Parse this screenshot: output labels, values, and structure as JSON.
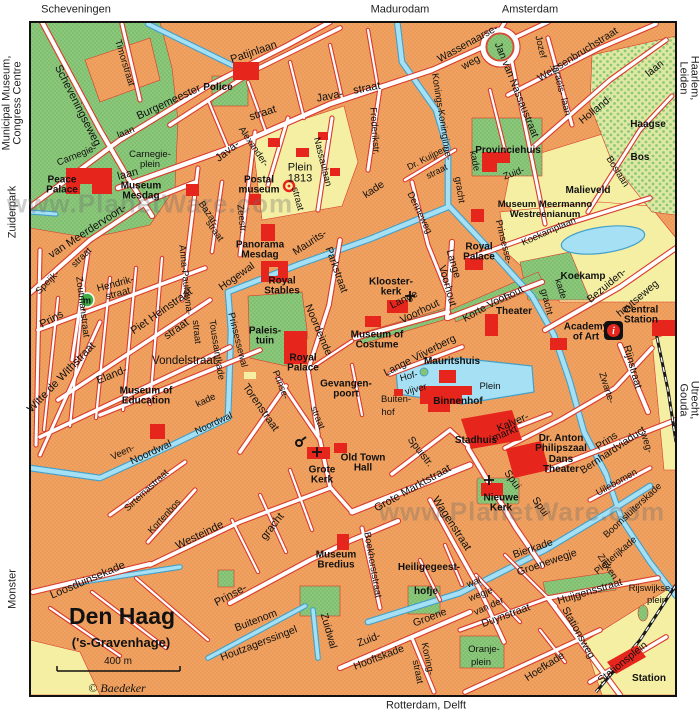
{
  "colors": {
    "land": "#efa261",
    "street": "#ffffff",
    "street_casing": "#d93b2c",
    "water": "#a5e0f5",
    "water_edge": "#44a0c8",
    "park": "#8cc87c",
    "wood": "#dfe8a0",
    "field": "#f4efa3",
    "building": "#e6251c",
    "rail": "#1a1a1a",
    "marker_green": "#3fae49",
    "border": "#111111"
  },
  "icons": {
    "info": "i",
    "stop": "m"
  },
  "labels": {
    "edge": [
      {
        "t": "Scheveningen",
        "x": 76,
        "y": 10
      },
      {
        "t": "Madurodam",
        "x": 400,
        "y": 10
      },
      {
        "t": "Amsterdam",
        "x": 530,
        "y": 10
      },
      {
        "t": "Haarlem, Leiden",
        "x": 688,
        "y": 78,
        "r": 90
      },
      {
        "t": "Utrecht, Gouda",
        "x": 688,
        "y": 400,
        "r": 90
      },
      {
        "t": "Rotterdam, Delft",
        "x": 426,
        "y": 706
      },
      {
        "t": "Municipal Museum,\nCongress Centre",
        "x": 13,
        "y": 103,
        "r": -90
      },
      {
        "t": "Zuiderpark",
        "x": 13,
        "y": 212,
        "r": -90
      },
      {
        "t": "Monster",
        "x": 13,
        "y": 589,
        "r": -90
      }
    ],
    "watermarks": [
      {
        "t": "www.PlanetWare.com",
        "x": 150,
        "y": 204
      },
      {
        "t": "www.PlanetWare.com",
        "x": 522,
        "y": 512
      }
    ],
    "titles": [
      {
        "t": "Den Haag",
        "x": 122,
        "y": 617,
        "fs": 23
      },
      {
        "t": "('s-Gravenhage)",
        "x": 121,
        "y": 643,
        "fs": 13
      },
      {
        "t": "400 m",
        "x": 118,
        "y": 662,
        "fs": 10,
        "b": 0
      },
      {
        "t": "© Baedeker",
        "x": 117,
        "y": 688,
        "fs": 12,
        "b": 0,
        "it": 1,
        "sf": 1
      }
    ],
    "streets": [
      {
        "t": "Scheveningseweg",
        "x": 77,
        "y": 106,
        "r": 63,
        "fs": 11
      },
      {
        "t": "Timorstraat",
        "x": 124,
        "y": 63,
        "r": 73
      },
      {
        "t": "Burgemeester",
        "x": 169,
        "y": 103,
        "r": -25,
        "fs": 11
      },
      {
        "t": "Patijnlaan",
        "x": 254,
        "y": 53,
        "r": -19,
        "fs": 11
      },
      {
        "t": "Carnegie-",
        "x": 77,
        "y": 156,
        "r": -22
      },
      {
        "t": "laan",
        "x": 126,
        "y": 133,
        "r": -22
      },
      {
        "t": "Carnegie-\nplein",
        "x": 150,
        "y": 160
      },
      {
        "t": "Plein\n1813",
        "x": 300,
        "y": 174,
        "fs": 11
      },
      {
        "t": "laan",
        "x": 128,
        "y": 175,
        "r": -15,
        "fs": 11
      },
      {
        "t": "van Meerdervoort-",
        "x": 88,
        "y": 232,
        "r": -33,
        "fs": 11
      },
      {
        "t": "Speijk-",
        "x": 48,
        "y": 283,
        "r": -45
      },
      {
        "t": "straat",
        "x": 82,
        "y": 258,
        "r": -45
      },
      {
        "t": "Zoutmanstraat",
        "x": 82,
        "y": 307,
        "r": 83
      },
      {
        "t": "Prins",
        "x": 52,
        "y": 320,
        "r": -28,
        "fs": 11
      },
      {
        "t": "Hendrik-\nstraat",
        "x": 117,
        "y": 290,
        "r": -15,
        "fs": 10
      },
      {
        "t": "Piet Heinstraat",
        "x": 162,
        "y": 312,
        "r": -35,
        "fs": 11
      },
      {
        "t": "Witte de Withstraat",
        "x": 62,
        "y": 378,
        "r": -46,
        "fs": 11
      },
      {
        "t": "Eland-",
        "x": 112,
        "y": 376,
        "r": -22,
        "fs": 11
      },
      {
        "t": "straat",
        "x": 177,
        "y": 330,
        "r": -35,
        "fs": 11
      },
      {
        "t": "Vondelstraat",
        "x": 184,
        "y": 362,
        "fs": 11.5
      },
      {
        "t": "Anna-Paulowna-",
        "x": 185,
        "y": 280,
        "r": 84
      },
      {
        "t": "straat",
        "x": 196,
        "y": 332,
        "r": 84
      },
      {
        "t": "Bazar-",
        "x": 208,
        "y": 214,
        "r": 55
      },
      {
        "t": "straat",
        "x": 214,
        "y": 231,
        "r": 55
      },
      {
        "t": "Zeestr.",
        "x": 241,
        "y": 219,
        "r": 84
      },
      {
        "t": "straat",
        "x": 263,
        "y": 114,
        "r": -18,
        "fs": 11
      },
      {
        "t": "Java-",
        "x": 228,
        "y": 152,
        "r": -38,
        "fs": 11
      },
      {
        "t": "Java-",
        "x": 330,
        "y": 97,
        "r": -11,
        "fs": 11
      },
      {
        "t": "straat",
        "x": 367,
        "y": 89,
        "r": -11,
        "fs": 11
      },
      {
        "t": "Alexander-",
        "x": 253,
        "y": 147,
        "r": 56
      },
      {
        "t": "straat",
        "x": 297,
        "y": 199,
        "r": 75
      },
      {
        "t": "Nassaulaan",
        "x": 322,
        "y": 162,
        "r": 76
      },
      {
        "t": "Frederikstr.",
        "x": 374,
        "y": 131,
        "r": 86
      },
      {
        "t": "Maurits-",
        "x": 310,
        "y": 243,
        "r": -33,
        "fs": 10.5
      },
      {
        "t": "kade",
        "x": 374,
        "y": 190,
        "r": -33,
        "fs": 10.5
      },
      {
        "t": "Hogewal",
        "x": 237,
        "y": 277,
        "r": -35,
        "fs": 10.5
      },
      {
        "t": "Parkstraat",
        "x": 336,
        "y": 270,
        "r": 70,
        "fs": 10.5
      },
      {
        "t": "Noordeinde",
        "x": 318,
        "y": 330,
        "r": 67,
        "fs": 10.5
      },
      {
        "t": "Toussaintkade",
        "x": 216,
        "y": 350,
        "r": 81
      },
      {
        "t": "Prinsessewal",
        "x": 237,
        "y": 340,
        "r": 76
      },
      {
        "t": "Prinse-",
        "x": 280,
        "y": 385,
        "r": 68
      },
      {
        "t": "straat",
        "x": 317,
        "y": 418,
        "r": 68
      },
      {
        "t": "Torenstraat",
        "x": 260,
        "y": 408,
        "r": 55,
        "fs": 11
      },
      {
        "t": "kade",
        "x": 206,
        "y": 401,
        "r": -25
      },
      {
        "t": "Noordwal",
        "x": 214,
        "y": 424,
        "r": -25
      },
      {
        "t": "Veen-",
        "x": 123,
        "y": 453,
        "r": -25
      },
      {
        "t": "Noordwal",
        "x": 151,
        "y": 453,
        "r": -25,
        "fs": 10.5
      },
      {
        "t": "Lange",
        "x": 404,
        "y": 300,
        "r": -26,
        "fs": 10.5
      },
      {
        "t": "Voorhout",
        "x": 420,
        "y": 312,
        "r": -26,
        "fs": 10.5
      },
      {
        "t": "Lange",
        "x": 453,
        "y": 264,
        "r": 74,
        "fs": 10.5
      },
      {
        "t": "Voorhout",
        "x": 447,
        "y": 286,
        "r": 74,
        "fs": 10.5
      },
      {
        "t": "Korte Voor-",
        "x": 487,
        "y": 307,
        "r": -29,
        "fs": 10.5
      },
      {
        "t": "hout",
        "x": 514,
        "y": 294,
        "r": -29,
        "fs": 10.5
      },
      {
        "t": "Lange Vijverberg",
        "x": 420,
        "y": 356,
        "r": -27,
        "fs": 10.5
      },
      {
        "t": "Hof-",
        "x": 409,
        "y": 377,
        "r": -15
      },
      {
        "t": "vijver",
        "x": 416,
        "y": 390,
        "r": -15
      },
      {
        "t": "Buiten-",
        "x": 396,
        "y": 400
      },
      {
        "t": "hof",
        "x": 388,
        "y": 413
      },
      {
        "t": "Plein",
        "x": 490,
        "y": 387
      },
      {
        "t": "Wassenaarse-",
        "x": 468,
        "y": 44,
        "r": -29,
        "fs": 10.5
      },
      {
        "t": "weg",
        "x": 471,
        "y": 63,
        "r": -29,
        "fs": 10.5
      },
      {
        "t": "Jan van Nassaustraat",
        "x": 516,
        "y": 90,
        "r": 68,
        "fs": 10.5
      },
      {
        "t": "Jozef",
        "x": 540,
        "y": 47,
        "r": 77
      },
      {
        "t": "Israels-",
        "x": 558,
        "y": 80,
        "r": 77
      },
      {
        "t": "laan",
        "x": 565,
        "y": 107,
        "r": 77
      },
      {
        "t": "Weissenbruchstraat",
        "x": 578,
        "y": 55,
        "r": -32,
        "fs": 10.5
      },
      {
        "t": "Holland-",
        "x": 596,
        "y": 110,
        "r": -39,
        "fs": 10.5
      },
      {
        "t": "laan",
        "x": 655,
        "y": 69,
        "r": -39,
        "fs": 10.5
      },
      {
        "t": "Boslaan",
        "x": 617,
        "y": 172,
        "r": 58
      },
      {
        "t": "Konings-",
        "x": 437,
        "y": 92,
        "r": 81
      },
      {
        "t": "Koninginne-",
        "x": 444,
        "y": 135,
        "r": 81
      },
      {
        "t": "gracht",
        "x": 459,
        "y": 190,
        "r": 81
      },
      {
        "t": "kade",
        "x": 474,
        "y": 161,
        "r": 78
      },
      {
        "t": "Dr. Kuijper-",
        "x": 428,
        "y": 158,
        "r": -27,
        "fs": 9
      },
      {
        "t": "straat",
        "x": 437,
        "y": 172,
        "r": -27,
        "fs": 9
      },
      {
        "t": "Denneweg",
        "x": 419,
        "y": 213,
        "r": 64
      },
      {
        "t": "Zuid-",
        "x": 514,
        "y": 174,
        "r": -20
      },
      {
        "t": "Prinsesse-",
        "x": 503,
        "y": 242,
        "r": 76
      },
      {
        "t": "gracht",
        "x": 546,
        "y": 302,
        "r": 76
      },
      {
        "t": "kade",
        "x": 560,
        "y": 289,
        "r": 72
      },
      {
        "t": "Koekamplaan",
        "x": 549,
        "y": 232,
        "r": -24
      },
      {
        "t": "Bezuiden-",
        "x": 607,
        "y": 286,
        "r": -40,
        "fs": 10.5
      },
      {
        "t": "houtseweg",
        "x": 638,
        "y": 299,
        "r": -40,
        "fs": 10.5
      },
      {
        "t": "Rijnstraat",
        "x": 632,
        "y": 367,
        "r": 74,
        "fs": 10.5
      },
      {
        "t": "Zwarte-",
        "x": 606,
        "y": 388,
        "r": 72
      },
      {
        "t": "weg-",
        "x": 646,
        "y": 443,
        "r": 72
      },
      {
        "t": "Prins Bernhardviaduct",
        "x": 610,
        "y": 446,
        "r": -34,
        "fs": 10.5
      },
      {
        "t": "Kalver-",
        "x": 513,
        "y": 423,
        "r": -23,
        "fs": 10.5
      },
      {
        "t": "markt",
        "x": 505,
        "y": 434,
        "r": -23,
        "fs": 10.5
      },
      {
        "t": "Spuistr.",
        "x": 420,
        "y": 452,
        "r": 52,
        "fs": 10.5
      },
      {
        "t": "Grote Marktstraat",
        "x": 413,
        "y": 489,
        "r": -29,
        "fs": 11
      },
      {
        "t": "Wagenstraat",
        "x": 451,
        "y": 524,
        "r": 57,
        "fs": 11
      },
      {
        "t": "Spui",
        "x": 512,
        "y": 480,
        "r": 55,
        "fs": 10.5
      },
      {
        "t": "Spui",
        "x": 540,
        "y": 507,
        "r": 55,
        "fs": 10.5
      },
      {
        "t": "gracht",
        "x": 273,
        "y": 527,
        "r": -52,
        "fs": 11
      },
      {
        "t": "Boekhorststraat",
        "x": 372,
        "y": 565,
        "r": 80
      },
      {
        "t": "Westeinde",
        "x": 200,
        "y": 536,
        "r": -26,
        "fs": 11
      },
      {
        "t": "Kortenbos",
        "x": 165,
        "y": 517,
        "r": -47
      },
      {
        "t": "Sirtemastraat",
        "x": 147,
        "y": 491,
        "r": -43
      },
      {
        "t": "Loosduinsekade",
        "x": 88,
        "y": 581,
        "r": -23,
        "fs": 11
      },
      {
        "t": "Prinse-",
        "x": 231,
        "y": 596,
        "r": -28,
        "fs": 11
      },
      {
        "t": "Buitenom",
        "x": 256,
        "y": 621,
        "r": -21,
        "fs": 10.5
      },
      {
        "t": "Houtzagerssingel",
        "x": 259,
        "y": 644,
        "r": -21,
        "fs": 10.5
      },
      {
        "t": "Zuidwal",
        "x": 328,
        "y": 631,
        "r": 74,
        "fs": 10.5
      },
      {
        "t": "Zuid-",
        "x": 369,
        "y": 640,
        "r": -21,
        "fs": 10.5
      },
      {
        "t": "Hooftskade",
        "x": 379,
        "y": 658,
        "r": -21,
        "fs": 10.5
      },
      {
        "t": "Koning-",
        "x": 427,
        "y": 659,
        "r": 78
      },
      {
        "t": "straat",
        "x": 417,
        "y": 672,
        "r": 78
      },
      {
        "t": "Oranje-",
        "x": 484,
        "y": 650
      },
      {
        "t": "plein",
        "x": 481,
        "y": 663
      },
      {
        "t": "Groene",
        "x": 430,
        "y": 618,
        "r": -21,
        "fs": 10.5
      },
      {
        "t": "wal",
        "x": 474,
        "y": 583,
        "r": -21
      },
      {
        "t": "wegje",
        "x": 481,
        "y": 595,
        "r": -21
      },
      {
        "t": "van der",
        "x": 489,
        "y": 607,
        "r": -24
      },
      {
        "t": "Duynstraat",
        "x": 506,
        "y": 616,
        "r": -20,
        "fs": 10.5
      },
      {
        "t": "Huijgensstraat",
        "x": 590,
        "y": 592,
        "r": -17,
        "fs": 10.5
      },
      {
        "t": "Bierkade",
        "x": 533,
        "y": 549,
        "r": -19,
        "fs": 10.5
      },
      {
        "t": "Groenewegje",
        "x": 547,
        "y": 563,
        "r": -19,
        "fs": 10.5
      },
      {
        "t": "Uilebomen",
        "x": 617,
        "y": 483,
        "r": -29
      },
      {
        "t": "Boomsluiterskade",
        "x": 633,
        "y": 511,
        "r": -43
      },
      {
        "t": "Pletterijkade",
        "x": 616,
        "y": 556,
        "r": -41
      },
      {
        "t": "Zieken",
        "x": 607,
        "y": 567,
        "r": 56
      },
      {
        "t": "Rijswijkse-",
        "x": 651,
        "y": 589
      },
      {
        "t": "plein",
        "x": 657,
        "y": 601
      },
      {
        "t": "Stationsweg",
        "x": 578,
        "y": 633,
        "r": 61,
        "fs": 10.5
      },
      {
        "t": "Stationsplein",
        "x": 623,
        "y": 663,
        "r": -39,
        "fs": 10.5
      },
      {
        "t": "Hoefkade",
        "x": 545,
        "y": 667,
        "r": -33,
        "fs": 10.5
      }
    ],
    "pois": [
      {
        "t": "Police",
        "x": 218,
        "y": 88,
        "fs": 10
      },
      {
        "t": "Peace\nPalace",
        "x": 62,
        "y": 186,
        "fs": 10
      },
      {
        "t": "Museum\nMesdag",
        "x": 141,
        "y": 192,
        "fs": 10
      },
      {
        "t": "Postal\nmuseum",
        "x": 259,
        "y": 186,
        "fs": 10
      },
      {
        "t": "Panorama\nMesdag",
        "x": 260,
        "y": 251,
        "fs": 10
      },
      {
        "t": "Royal\nStables",
        "x": 282,
        "y": 287,
        "fs": 10
      },
      {
        "t": "Paleis-\ntuin",
        "x": 265,
        "y": 337,
        "fs": 10
      },
      {
        "t": "Royal\nPalace",
        "x": 303,
        "y": 364,
        "fs": 10
      },
      {
        "t": "Klooster-\nkerk",
        "x": 391,
        "y": 288,
        "fs": 10
      },
      {
        "t": "Museum of\nCostume",
        "x": 377,
        "y": 341,
        "fs": 10
      },
      {
        "t": "Mauritshuis",
        "x": 452,
        "y": 362,
        "fs": 10
      },
      {
        "t": "Gevangen-\npoort",
        "x": 346,
        "y": 390,
        "fs": 10
      },
      {
        "t": "Binnenhof",
        "x": 458,
        "y": 402,
        "fs": 10
      },
      {
        "t": "Royal\nPalace",
        "x": 479,
        "y": 253,
        "fs": 10
      },
      {
        "t": "Theater",
        "x": 514,
        "y": 312,
        "fs": 10
      },
      {
        "t": "Academy\nof Art",
        "x": 586,
        "y": 333,
        "fs": 10
      },
      {
        "t": "Central\nStation",
        "x": 641,
        "y": 316,
        "fs": 10
      },
      {
        "t": "Koekamp",
        "x": 583,
        "y": 277,
        "fs": 10
      },
      {
        "t": "Malieveld",
        "x": 588,
        "y": 191,
        "fs": 10
      },
      {
        "t": "Haagse",
        "x": 648,
        "y": 125,
        "fs": 10
      },
      {
        "t": "Bos",
        "x": 640,
        "y": 158,
        "fs": 10
      },
      {
        "t": "Provinciehuis",
        "x": 508,
        "y": 151,
        "fs": 10
      },
      {
        "t": "Museum Meermanno\nWestreenianum",
        "x": 545,
        "y": 210
      },
      {
        "t": "Museum of\nEducation",
        "x": 146,
        "y": 397,
        "fs": 10
      },
      {
        "t": "Old Town\nHall",
        "x": 363,
        "y": 464,
        "fs": 10
      },
      {
        "t": "Grote\nKerk",
        "x": 322,
        "y": 476,
        "fs": 10
      },
      {
        "t": "Stadhuis",
        "x": 476,
        "y": 441,
        "fs": 10
      },
      {
        "t": "Dr. Anton\nPhilipszaal\nDans\nTheater",
        "x": 561,
        "y": 455,
        "fs": 10
      },
      {
        "t": "Nieuwe\nKerk",
        "x": 501,
        "y": 504,
        "fs": 10
      },
      {
        "t": "Museum\nBredius",
        "x": 336,
        "y": 561,
        "fs": 10
      },
      {
        "t": "Heiligegeest-",
        "x": 429,
        "y": 568,
        "fs": 10
      },
      {
        "t": "hofje",
        "x": 426,
        "y": 592,
        "fs": 10
      },
      {
        "t": "Station",
        "x": 649,
        "y": 679,
        "fs": 10
      }
    ]
  }
}
